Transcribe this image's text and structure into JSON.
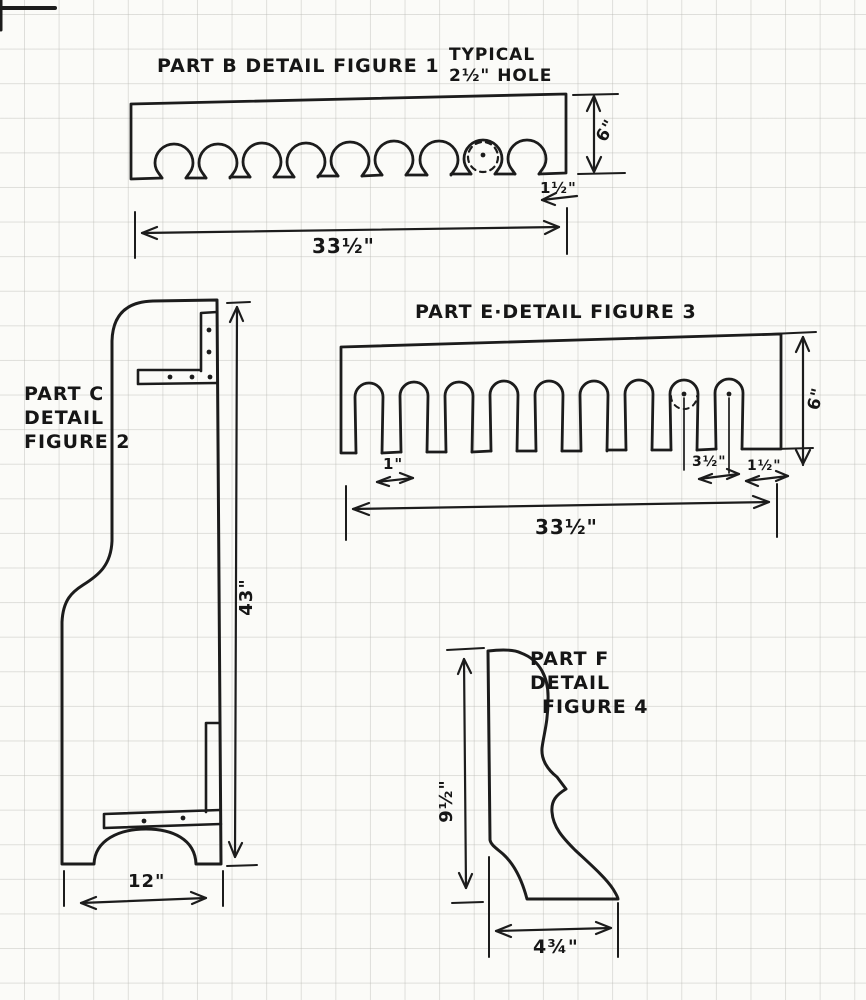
{
  "page": {
    "paper_color": "#fbfbf8",
    "grid_color": "#b7b7b2",
    "ink_color": "#1c1c1c"
  },
  "figure1": {
    "title": "PART B DETAIL FIGURE 1",
    "note_line1": "TYPICAL",
    "note_line2": "2½\" HOLE",
    "dim_height": "6\"",
    "dim_edge_offset": "1½\"",
    "dim_length": "33½\""
  },
  "figure2": {
    "label_line1": "PART C",
    "label_line2": "DETAIL",
    "label_line3": "FIGURE 2",
    "dim_height": "43\"",
    "dim_width": "12\""
  },
  "figure3": {
    "title": "PART E·DETAIL FIGURE 3",
    "dim_height": "6\"",
    "dim_slot_width": "1\"",
    "dim_slot_spacing": "3½\"",
    "dim_edge_offset": "1½\"",
    "dim_length": "33½\""
  },
  "figure4": {
    "label_line1": "PART F",
    "label_line2": "DETAIL",
    "label_line3": "FIGURE 4",
    "dim_height": "9½\"",
    "dim_width": "4¾\""
  }
}
